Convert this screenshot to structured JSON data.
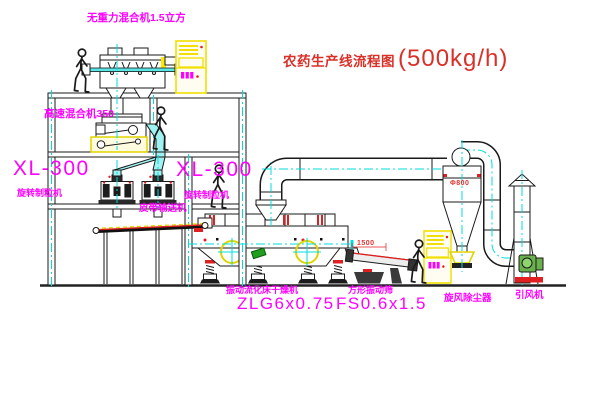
{
  "title": {
    "text": "农药生产线流程图",
    "capacity": "(500kg/h)"
  },
  "equipment": {
    "gravity_mixer": {
      "label": "无重力混合机1.5立方"
    },
    "high_speed_mixer": {
      "label": "高速混合机350"
    },
    "granulator_left": {
      "model": "XL-300",
      "name": "旋转制粒机"
    },
    "granulator_right": {
      "model": "XL-300",
      "name": "旋转制粒机"
    },
    "belt_conveyor": {
      "label": "皮带输送机"
    },
    "fluid_bed_dryer": {
      "name": "振动流化床干燥机",
      "model": "ZLG6x0.75"
    },
    "square_sieve": {
      "name": "方形振动筛",
      "model": "FS0.6x1.5",
      "dimension": "1500"
    },
    "cyclone": {
      "name": "旋风除尘器",
      "dimension": "Φ800"
    },
    "fan": {
      "name": "引风机"
    }
  },
  "colors": {
    "label_magenta": "#ff00ff",
    "title_red": "#d93028",
    "centerline_cyan": "#00dcdc",
    "highlight_yellow": "#f0df00",
    "accent_red": "#e02020",
    "line_black": "#1a1a1a"
  }
}
